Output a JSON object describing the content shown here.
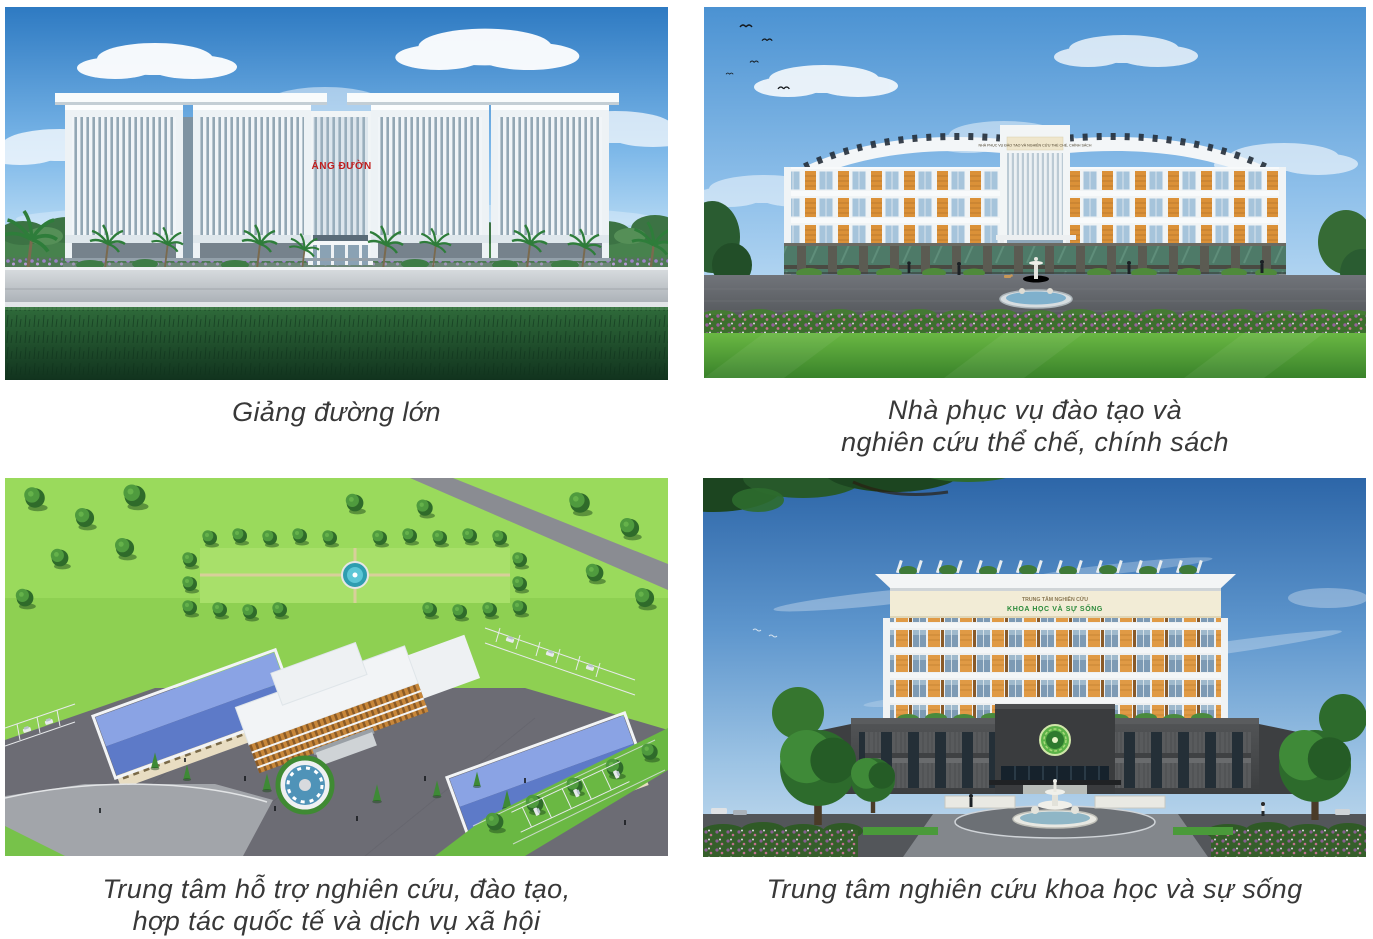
{
  "figures": [
    {
      "id": "lecture-hall",
      "caption_line1": "Giảng đường lớn",
      "sign": "GIẢNG ĐƯỜNG"
    },
    {
      "id": "training-policy-research-house",
      "caption_line1": "Nhà phục vụ đào tạo và",
      "caption_line2": "nghiên cứu thể chế, chính sách",
      "sign": "NHÀ PHỤC VỤ ĐÀO TẠO VÀ NGHIÊN CỨU THỂ CHẾ, CHÍNH SÁCH"
    },
    {
      "id": "support-center-aerial",
      "caption_line1": "Trung tâm hỗ trợ nghiên cứu, đào tạo,",
      "caption_line2": "hợp tác quốc tế và dịch vụ xã hội"
    },
    {
      "id": "life-science-research-center",
      "caption_line1": "Trung tâm nghiên cứu khoa học và sự sống",
      "sign_line1": "TRUNG TÂM NGHIÊN CỨU",
      "sign_line2": "KHOA HỌC VÀ SỰ SỐNG"
    }
  ],
  "palette": {
    "caption_text": "#383838",
    "sky_blue": "#5d95cc",
    "building_white": "#f2f5f7",
    "facade_orange": "#e09a45",
    "sign_red": "#c01d1d",
    "sign_green": "#2a8a3a",
    "grass_dark": "#2f6b3a",
    "lawn_bright": "#6ab843",
    "aerial_lawn": "#8ed052",
    "roof_blue": "#7e9adf",
    "stone_dark": "#494b4d",
    "plaza_gray": "#6c6c74",
    "flower_purple": "#96619c"
  }
}
